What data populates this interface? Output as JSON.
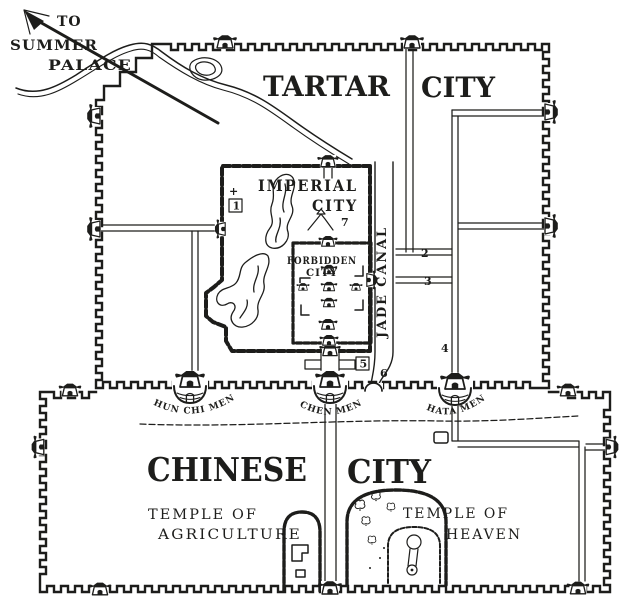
{
  "colors": {
    "ink": "#1d1d1b",
    "paper": "#ffffff"
  },
  "direction_note": {
    "l1": "TO",
    "l2": "SUMMER",
    "l3": "PALACE"
  },
  "regions": {
    "tartar": {
      "w1": "TARTAR",
      "w2": "CITY"
    },
    "chinese": {
      "w1": "CHINESE",
      "w2": "CITY"
    },
    "imperial": {
      "l1": "IMPERIAL",
      "l2": "CITY"
    },
    "forbidden": {
      "l1": "FORBIDDEN",
      "l2": "CITY"
    }
  },
  "waterways": {
    "jade_canal": "JADE CANAL"
  },
  "temples": {
    "agriculture": {
      "l1": "TEMPLE OF",
      "l2": "AGRICULTURE"
    },
    "heaven": {
      "l1": "TEMPLE OF",
      "l2": "HEAVEN"
    }
  },
  "gates": {
    "shun_chi_men": "SHUN CHI MEN",
    "chen_men": "CHEN MEN",
    "hata_men": "HATA MEN"
  },
  "markers": {
    "m1": "1",
    "m2": "2",
    "m3": "3",
    "m4": "4",
    "m5": "5",
    "m6": "6",
    "m7": "7",
    "cross": "+"
  }
}
